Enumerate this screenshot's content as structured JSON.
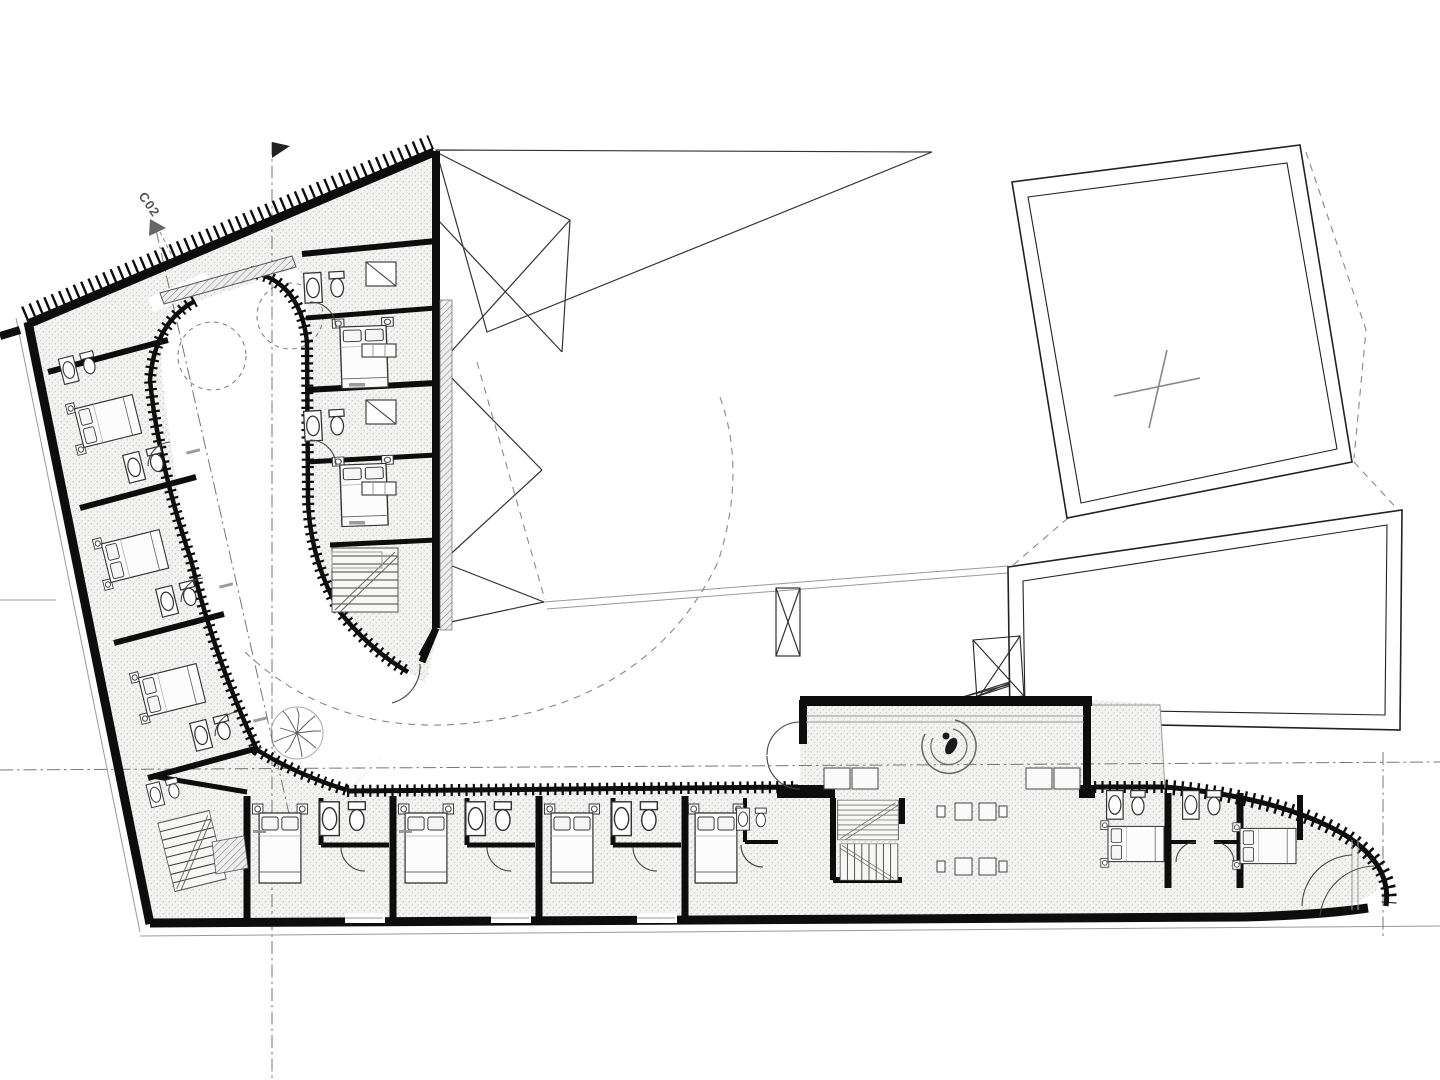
{
  "plan": {
    "title": "Floor plan drawing",
    "section_marker": {
      "label": "C02"
    },
    "summary": {
      "guest_beds_visible": 11,
      "bathrooms_visible": 11,
      "staircases_visible": 3,
      "pool_or_roof_outlines": 2,
      "tree_symbols": 1,
      "reception_desks": 1
    },
    "colors": {
      "paper": "#ffffff",
      "wall": "#0d0d0d",
      "linework": "#333333",
      "secondary_line": "#888888",
      "floor_fill": "#f3f3f1",
      "floor_dot": "#bdbdb8",
      "label_gray": "#555555"
    },
    "icons": {
      "tree": "tree-icon",
      "reception": "reception-desk-icon",
      "section_arrow": "section-arrow-icon",
      "north_flag": "axis-flag-icon"
    }
  }
}
